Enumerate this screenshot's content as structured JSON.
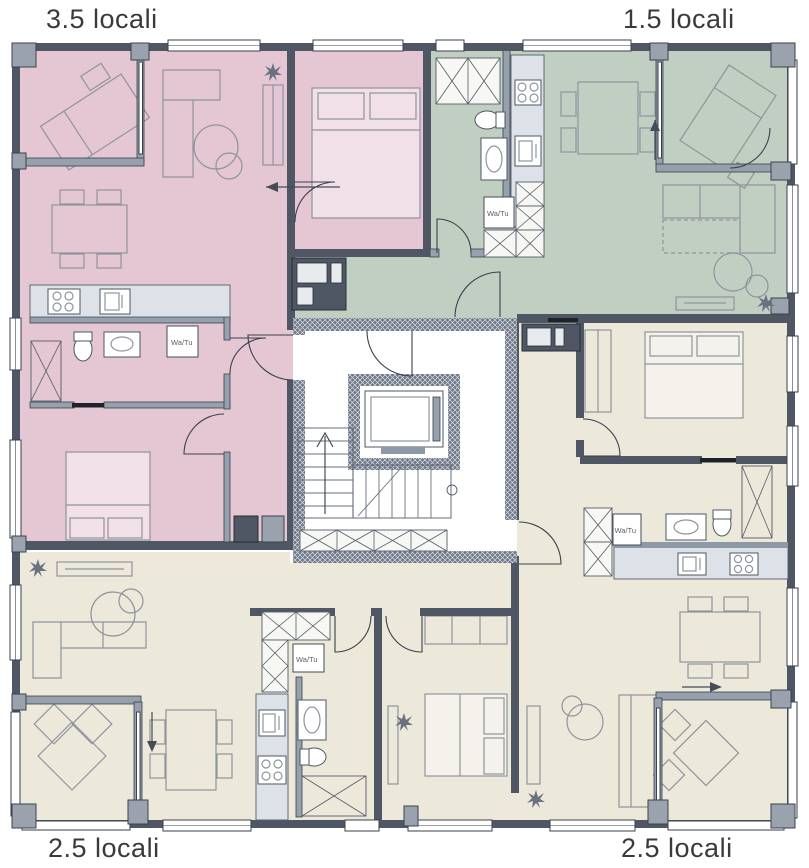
{
  "plan": {
    "apartments": [
      {
        "name": "top-left",
        "label": "3.5 locali",
        "color": "#e5c6d3"
      },
      {
        "name": "top-right",
        "label": "1.5 locali",
        "color": "#c1cfc3"
      },
      {
        "name": "bottom-left",
        "label": "2.5 locali",
        "color": "#ece8da"
      },
      {
        "name": "bottom-right",
        "label": "2.5 locali",
        "color": "#ece8da"
      }
    ],
    "annotations": {
      "washer_dryer": "Wa/Tu"
    },
    "colors": {
      "wall_dark": "#4e5763",
      "wall_light": "#96a1ad",
      "window": "#ffffff",
      "core_floor": "#ffffff",
      "furniture_line": "#8f949d",
      "label_text": "#3a3a3a"
    }
  }
}
